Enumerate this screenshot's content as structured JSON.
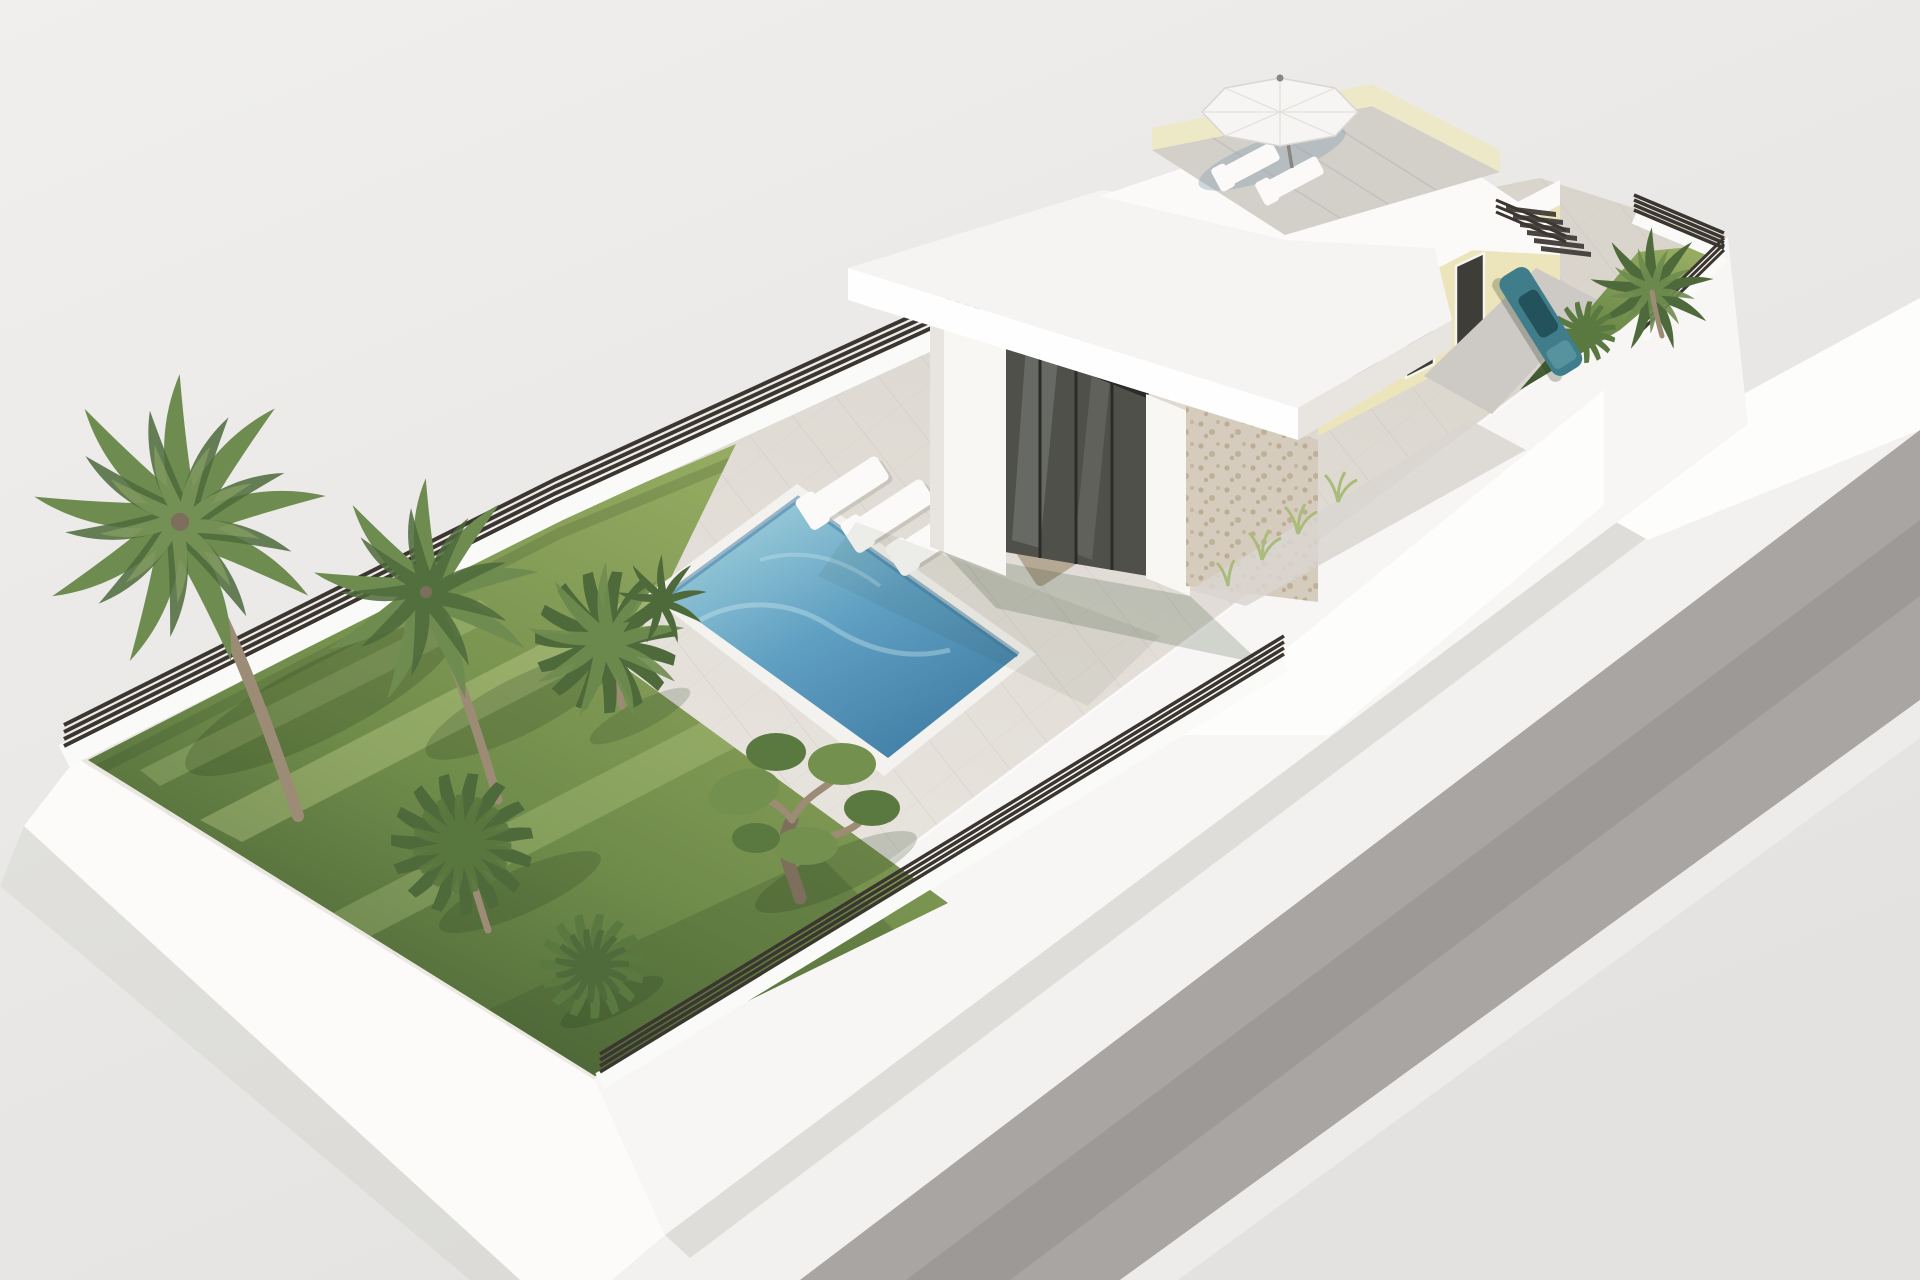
{
  "title": "3D architectural render — modern villa plot with pool, lawn garden and roof terrace",
  "caption": "Aerial 3D visualization of an elevated rectangular villa plot: green lawn with palm trees, an olive tree and shrubs, rectangular swimming pool with three white sun loungers, covered porch with wicker lounge set, white flat-roof villa with stone and cream facades, roof terrace with white parasol and two loungers, external stair, parked teal car, side garden strip, dark slatted perimeter fence and a grey road along the plot.",
  "counts": {
    "palm_trees": 6,
    "olive_trees": 1,
    "shrubs": 2,
    "poolside_loungers": 3,
    "rooftop_loungers": 2,
    "wicker_armchairs": 2,
    "wicker_ottomans": 2,
    "parasols": 1,
    "cars": 1,
    "pools": 1,
    "stair_steps": 6
  },
  "colors": {
    "bg_top": "#f0efed",
    "bg_bottom": "#e4e2e0",
    "sidewalk": "#f3f1ef",
    "road": "#a9a5a2",
    "road_shadow": "#8f8b88",
    "curb": "#eeecea",
    "platform_wall": "#fcfbfa",
    "se_wall": "#f8f6f4",
    "wall_wedge": "#fdfdfc",
    "deck_light": "#edeae4",
    "deck_dark": "#d9d4cc",
    "tile_line": "#b9b5ae",
    "lawn_light": "#96ac62",
    "lawn_mid": "#6f8b4a",
    "lawn_dark": "#3f5830",
    "grass_streak": "#d8e6a0",
    "pool_coping": "#f4f2ee",
    "pool_light": "#a7d5de",
    "pool_mid": "#5f9fc2",
    "pool_deep": "#3e7aa2",
    "caustic": "#d6f0f4",
    "fence": "#3b362f",
    "fence_wall": "#fafaf8",
    "roof": "#f6f4f2",
    "fascia": "#fefefe",
    "fascia_side": "#e8e5e1",
    "column": "#f8f7f4",
    "glass": "#50504b",
    "glass_mullion": "#2b2b28",
    "reflection": "#b9c2bf",
    "stone": "#d6ccbd",
    "stone_speck": "#b5a489",
    "cream": "#ece4ba",
    "parapet": "#fbfaf8",
    "window": "#3e3d38",
    "window_frame": "#f6f4ef",
    "terrace_floor": "#d3cfc9",
    "railing": "#ede8c2",
    "umbrella": "#f6f5f3",
    "umbrella_seam": "#e2dfdb",
    "umbrella_shadow": "#8aa2b6",
    "pole": "#8a857e",
    "lounger": "#fbfaf8",
    "lounger_shadow": "#b7b2ac",
    "wicker": "#b6a994",
    "cushion": "#f5f3ee",
    "stairs": "#4a4540",
    "car_body": "#3e7d89",
    "car_glass": "#24525c",
    "car_highlight": "#5a97a3",
    "driveway": "#cdc9c4",
    "path_gray": "#d9d5d0",
    "trunk": "#9c8c75",
    "trunk_dark": "#7d6f5c",
    "palm_green": "#6f8c50",
    "palm_green_dark": "#4e6a3b",
    "palm_green_light": "#8ca763",
    "olive_green": "#74904e",
    "bush_green": "#5a7940",
    "tuft": "#aabb7c",
    "shadow": "#24351c"
  }
}
